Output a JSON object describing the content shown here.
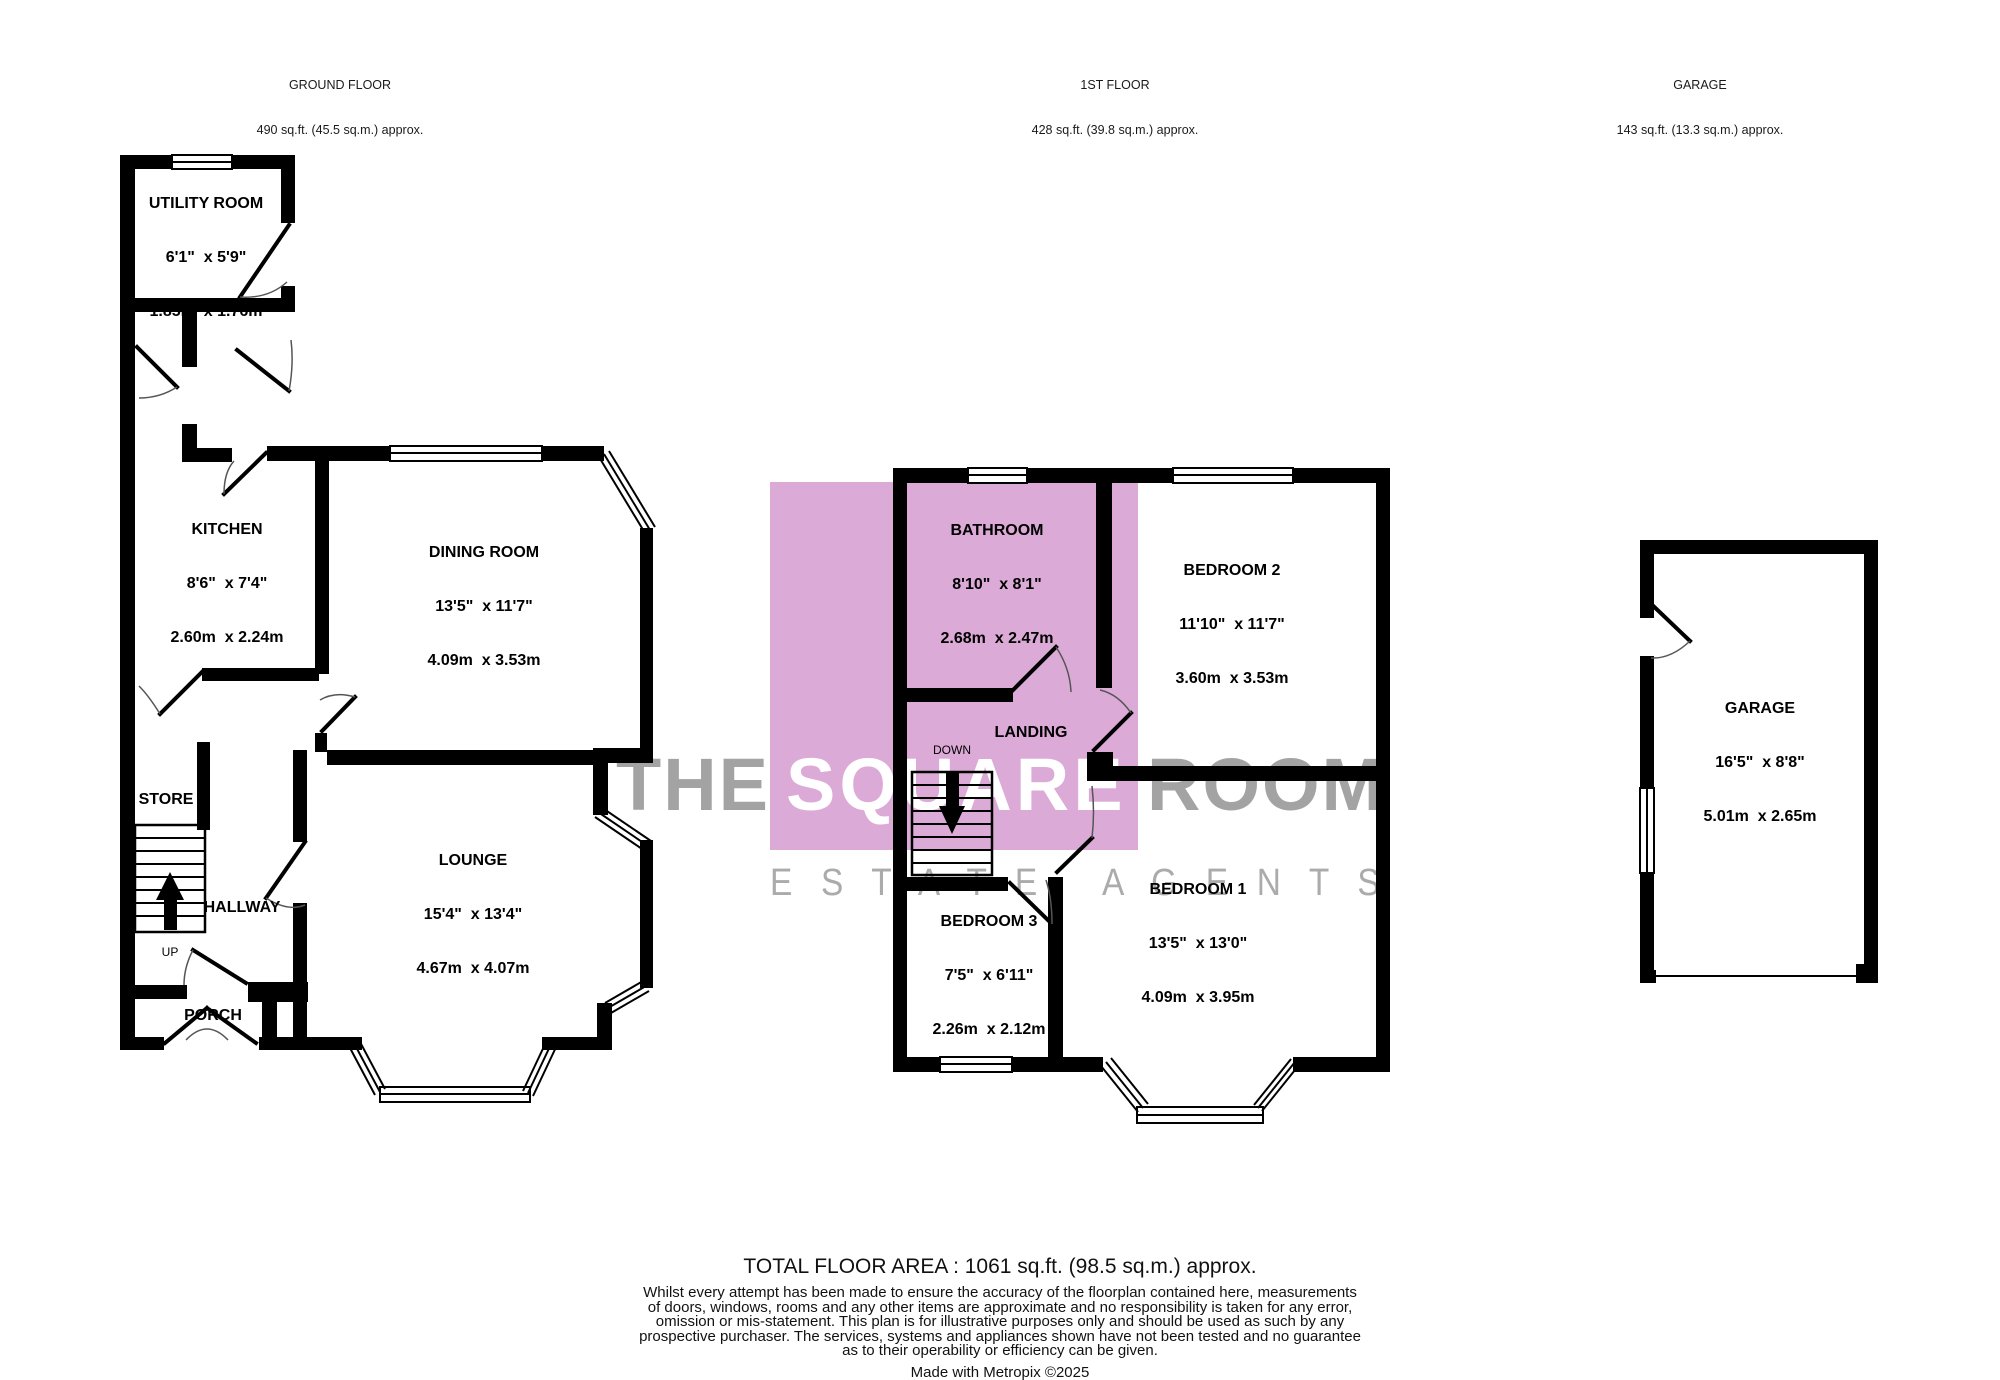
{
  "colors": {
    "wall": "#000000",
    "watermark_pink": "#dcaad7",
    "watermark_gray": "#a3a3a3",
    "page_bg": "#ffffff"
  },
  "headers": {
    "ground": {
      "title": "GROUND FLOOR",
      "area": "490 sq.ft. (45.5 sq.m.) approx."
    },
    "first": {
      "title": "1ST FLOOR",
      "area": "428 sq.ft. (39.8 sq.m.) approx."
    },
    "garage": {
      "title": "GARAGE",
      "area": "143 sq.ft. (13.3 sq.m.) approx."
    }
  },
  "rooms": {
    "utility": {
      "name": "UTILITY ROOM",
      "imperial": "6'1\"  x 5'9\"",
      "metric": "1.85m  x 1.76m"
    },
    "kitchen": {
      "name": "KITCHEN",
      "imperial": "8'6\"  x 7'4\"",
      "metric": "2.60m  x 2.24m"
    },
    "dining": {
      "name": "DINING ROOM",
      "imperial": "13'5\"  x 11'7\"",
      "metric": "4.09m  x 3.53m"
    },
    "lounge": {
      "name": "LOUNGE",
      "imperial": "15'4\"  x 13'4\"",
      "metric": "4.67m  x 4.07m"
    },
    "bathroom": {
      "name": "BATHROOM",
      "imperial": "8'10\"  x 8'1\"",
      "metric": "2.68m  x 2.47m"
    },
    "bedroom2": {
      "name": "BEDROOM 2",
      "imperial": "11'10\"  x 11'7\"",
      "metric": "3.60m  x 3.53m"
    },
    "bedroom3": {
      "name": "BEDROOM 3",
      "imperial": "7'5\"  x 6'11\"",
      "metric": "2.26m  x 2.12m"
    },
    "bedroom1": {
      "name": "BEDROOM 1",
      "imperial": "13'5\"  x 13'0\"",
      "metric": "4.09m  x 3.95m"
    },
    "garage": {
      "name": "GARAGE",
      "imperial": "16'5\"  x 8'8\"",
      "metric": "5.01m  x 2.65m"
    }
  },
  "labels": {
    "store": "STORE",
    "hallway": "HALLWAY",
    "porch": "PORCH",
    "landing": "LANDING",
    "up": "UP",
    "down": "DOWN"
  },
  "watermark": {
    "the": "THE",
    "square": "SQUARE",
    "room": "ROOM",
    "tagline": "E S T A T E   A G E N T S"
  },
  "footer": {
    "total": "TOTAL FLOOR AREA : 1061 sq.ft. (98.5 sq.m.) approx.",
    "disclaimer": [
      "Whilst every attempt has been made to ensure the accuracy of the floorplan contained here, measurements",
      "of doors, windows, rooms and any other items are approximate and no responsibility is taken for any error,",
      "omission or mis-statement. This plan is for illustrative purposes only and should be used as such by any",
      "prospective purchaser. The services, systems and appliances shown have not been tested and no guarantee",
      "as to their operability or efficiency can be given."
    ],
    "credit": "Made with Metropix ©2025"
  }
}
